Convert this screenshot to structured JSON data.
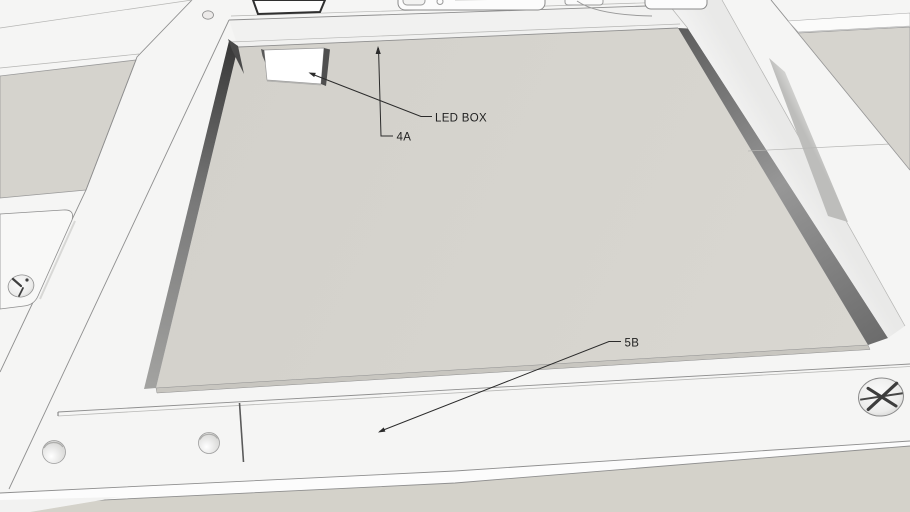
{
  "scene": {
    "description": "3D CAD model view of a recessed ceiling light panel assembly with callout annotations",
    "background_color": "#f5f5f4",
    "panel_color": "#d6d4ce",
    "left_panel_color": "#d5d3cd",
    "right_panel_color": "#d6d4ce",
    "floor_color": "#d4d2ca",
    "top_band_color": "#f1f1f0",
    "led_box_face_color": "#ffffff",
    "recess_wall_dark": "#4a4a4a",
    "edge_line_color": "#8f8f8f",
    "annotation_line_color": "#2b2b2b",
    "annotation_text_color": "#1f1f1f"
  },
  "annotations": {
    "led_box": {
      "label": "LED BOX"
    },
    "ref_4a": {
      "label": "4A"
    },
    "ref_5b": {
      "label": "5B"
    }
  }
}
